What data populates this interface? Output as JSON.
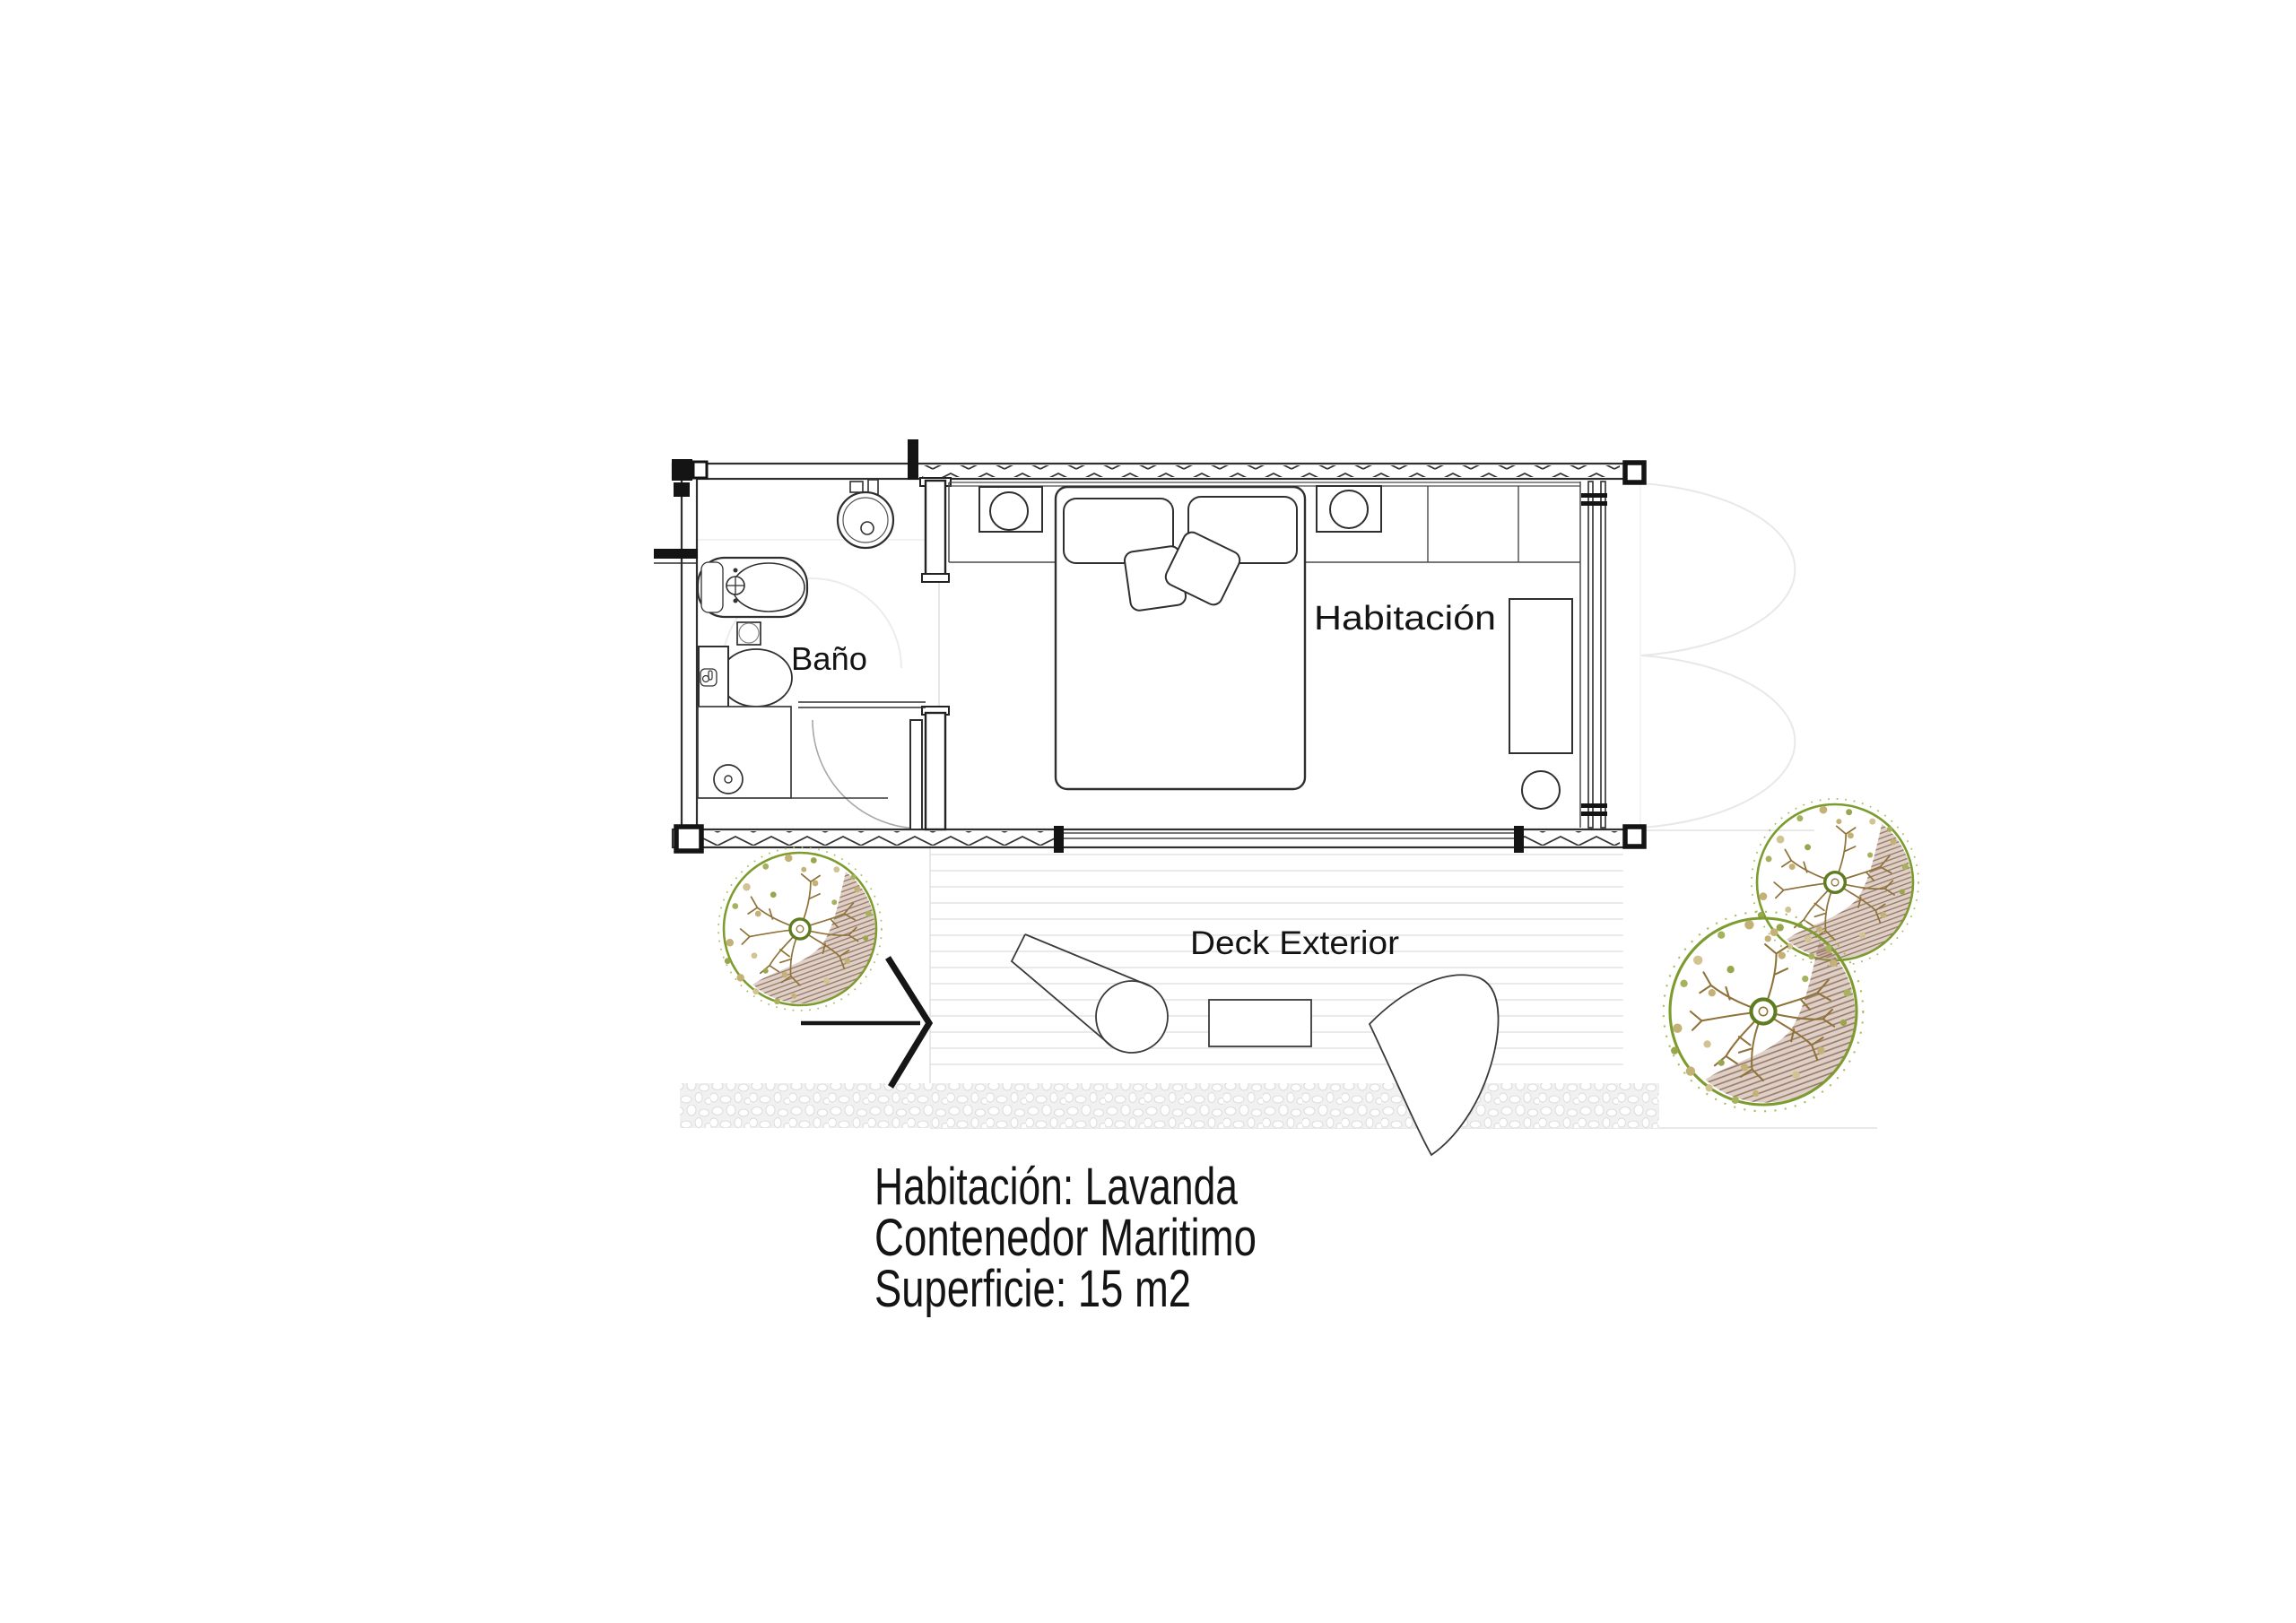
{
  "plan": {
    "labels": {
      "bathroom": "Baño",
      "bedroom": "Habitación",
      "deck": "Deck Exterior"
    },
    "caption": {
      "line1": "Habitación: Lavanda",
      "line2": "Contenedor Maritimo",
      "line3": "Superficie: 15 m2"
    },
    "colors": {
      "line": "#2f2f2f",
      "wall_black": "#141414",
      "faint_line": "#e8e8e8",
      "deck_plank": "#e4e4e4",
      "gravel_bg": "#f1f1f1",
      "tree_green": "#7d9c2f",
      "tree_fringe": "#a9bd5e",
      "branch_brown": "#8f7339",
      "shade_brown": "#8d6c59"
    },
    "icons": [
      "toilet-icon",
      "bidet-icon",
      "sink-icon",
      "shower-icon",
      "shower-drain-icon",
      "door-swing-icon",
      "bed-icon",
      "pillow-icon",
      "nightstand-lamp-icon",
      "desk-icon",
      "stool-icon",
      "window-wall-icon",
      "french-door-swing-icon",
      "tree-icon",
      "entrance-arrow-icon",
      "lounger-icon",
      "side-table-icon",
      "deck-chair-icon"
    ]
  }
}
